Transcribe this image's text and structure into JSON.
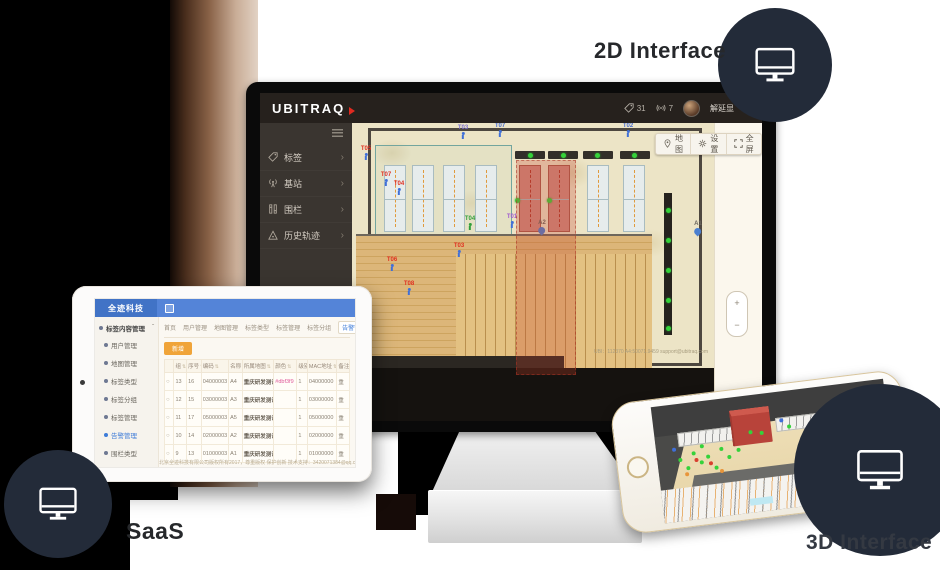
{
  "labels": {
    "label_2d": "2D Interface",
    "label_saas": "SaaS",
    "label_3d": "3D Interface"
  },
  "colors": {
    "badge_navy": "#232b39",
    "header_dark": "#26211d",
    "sidebar_dark": "#3a3530",
    "map_beige": "#ece4c6",
    "fence_red": "#c63f2c",
    "station_green": "#35d23a",
    "tag_blue": "#3f6fd8",
    "tablet_blue": "#5484d8",
    "tablet_logo_blue": "#4173c6",
    "accent_orange": "#f0a439",
    "active_blue": "#3d7bd8"
  },
  "monitor_app": {
    "logo": "UBITRAQ",
    "header": {
      "tag_count": "31",
      "signal_count": "7",
      "username": "解延显",
      "caret": "▼"
    },
    "sidebar_chevron": "›",
    "sidebar": [
      {
        "icon": "tag-icon",
        "label": "标签"
      },
      {
        "icon": "station-icon",
        "label": "基站"
      },
      {
        "icon": "fence-icon",
        "label": "围栏"
      },
      {
        "icon": "history-icon",
        "label": "历史轨迹"
      }
    ],
    "toolbar": [
      {
        "icon": "pin-icon",
        "label": "地图"
      },
      {
        "icon": "gear-icon",
        "label": "设置"
      },
      {
        "icon": "fullscreen-icon",
        "label": "全屏"
      }
    ],
    "zoom_in": "+",
    "zoom_out": "−",
    "watermark": "UBI：112370 A4:50071.9459 support@ubitraq.com",
    "map": {
      "racks": [
        {
          "x": 32,
          "y": 42,
          "red": false
        },
        {
          "x": 60,
          "y": 42,
          "red": false
        },
        {
          "x": 91,
          "y": 42,
          "red": false
        },
        {
          "x": 123,
          "y": 42,
          "red": false
        },
        {
          "x": 167,
          "y": 42,
          "red": true
        },
        {
          "x": 196,
          "y": 42,
          "red": true
        },
        {
          "x": 235,
          "y": 42,
          "red": false
        },
        {
          "x": 271,
          "y": 42,
          "red": false
        }
      ],
      "caps": [
        163,
        196,
        231,
        268
      ],
      "station_dots": [
        [
          178,
          32
        ],
        [
          211,
          32
        ],
        [
          245,
          32
        ],
        [
          282,
          32
        ],
        [
          165,
          77
        ],
        [
          197,
          77
        ],
        [
          316,
          87
        ],
        [
          316,
          117
        ],
        [
          316,
          147
        ],
        [
          316,
          177
        ],
        [
          316,
          205
        ]
      ],
      "tags": [
        {
          "x": 14,
          "y": 23,
          "label": "T05",
          "label_color": "#e03020",
          "icon_color": "#3f6fd8"
        },
        {
          "x": 111,
          "y": 2,
          "label": "T03",
          "label_color": "#7a6fd0",
          "icon_color": "#3f6fd8"
        },
        {
          "x": 148,
          "y": 0,
          "label": "T07",
          "label_color": "#4a6fd0",
          "icon_color": "#3f6fd8"
        },
        {
          "x": 276,
          "y": 0,
          "label": "T02",
          "label_color": "#4a6fd0",
          "icon_color": "#3f6fd8"
        },
        {
          "x": 34,
          "y": 49,
          "label": "T07",
          "label_color": "#e03020",
          "icon_color": "#3f6fd8"
        },
        {
          "x": 47,
          "y": 58,
          "label": "T04",
          "label_color": "#e03020",
          "icon_color": "#3f6fd8"
        },
        {
          "x": 118,
          "y": 93,
          "label": "T04",
          "label_color": "#2f9e3a",
          "icon_color": "#2f9e3a"
        },
        {
          "x": 160,
          "y": 91,
          "label": "T01",
          "label_color": "#a05bd0",
          "icon_color": "#3f6fd8"
        },
        {
          "x": 40,
          "y": 134,
          "label": "T06",
          "label_color": "#e03020",
          "icon_color": "#3f6fd8"
        },
        {
          "x": 57,
          "y": 158,
          "label": "T08",
          "label_color": "#e03020",
          "icon_color": "#3f6fd8"
        },
        {
          "x": 107,
          "y": 120,
          "label": "T03",
          "label_color": "#e03020",
          "icon_color": "#3f6fd8"
        }
      ],
      "pins": [
        {
          "x": 190,
          "y": 97,
          "label": "A2"
        },
        {
          "x": 346,
          "y": 98,
          "label": "A1"
        }
      ]
    }
  },
  "tablet_app": {
    "logo": "全迹科技",
    "sidebar_header": "标签内容管理",
    "sidebar_header_caret": "ˆ",
    "sidebar_items": [
      {
        "label": "用户管理",
        "active": false
      },
      {
        "label": "地图管理",
        "active": false
      },
      {
        "label": "标签类型",
        "active": false
      },
      {
        "label": "标签分组",
        "active": false
      },
      {
        "label": "标签管理",
        "active": false
      },
      {
        "label": "告警管理",
        "active": true
      },
      {
        "label": "围栏类型",
        "active": false
      },
      {
        "label": "围栏管理",
        "active": false
      },
      {
        "label": "围栏日志",
        "active": false
      }
    ],
    "tabs": [
      {
        "label": "首页",
        "active": false
      },
      {
        "label": "用户管理",
        "active": false
      },
      {
        "label": "地图管理",
        "active": false
      },
      {
        "label": "标签类型",
        "active": false
      },
      {
        "label": "标签管理",
        "active": false
      },
      {
        "label": "标签分组",
        "active": false
      },
      {
        "label": "告警管理",
        "active": true,
        "close": "×"
      }
    ],
    "add_button": "新增",
    "table": {
      "radio_icon": "○",
      "sort_icon": "⇅",
      "headers": [
        "",
        "组",
        "序号",
        "编码",
        "名称",
        "所属地图",
        "颜色",
        "级别",
        "MAC地址",
        "备注"
      ],
      "col_widths": [
        9,
        12,
        14,
        26,
        13,
        30,
        22,
        10,
        28,
        12
      ],
      "rows": [
        [
          "13",
          "16",
          "04000003",
          "A4",
          "重庆研发测试",
          "#dbf3f9",
          "1",
          "04000000",
          "重"
        ],
        [
          "12",
          "15",
          "03000003",
          "A3",
          "重庆研发测试",
          "",
          "1",
          "03000000",
          "重"
        ],
        [
          "11",
          "17",
          "05000003",
          "A5",
          "重庆研发测试",
          "",
          "1",
          "05000000",
          "重"
        ],
        [
          "10",
          "14",
          "02000003",
          "A2",
          "重庆研发测试",
          "",
          "1",
          "02000000",
          "重"
        ],
        [
          "9",
          "13",
          "01000003",
          "A1",
          "重庆研发测试",
          "",
          "1",
          "01000000",
          "重"
        ]
      ]
    },
    "footer": "北京全迹科技有限公司版权所有2017，尊重版权 保护创新 技术支持：3420071384@qq.com"
  },
  "phone_app": {
    "dots": [
      {
        "x": 9,
        "y": 46,
        "c": "#35d23a"
      },
      {
        "x": 12,
        "y": 54,
        "c": "#35d23a"
      },
      {
        "x": 15,
        "y": 42,
        "c": "#35d23a"
      },
      {
        "x": 18,
        "y": 50,
        "c": "#35d23a"
      },
      {
        "x": 21,
        "y": 46,
        "c": "#35d23a"
      },
      {
        "x": 24,
        "y": 56,
        "c": "#35d23a"
      },
      {
        "x": 27,
        "y": 41,
        "c": "#35d23a"
      },
      {
        "x": 30,
        "y": 49,
        "c": "#35d23a"
      },
      {
        "x": 19,
        "y": 37,
        "c": "#35d23a"
      },
      {
        "x": 34,
        "y": 44,
        "c": "#35d23a"
      },
      {
        "x": 40,
        "y": 30,
        "c": "#35d23a"
      },
      {
        "x": 45,
        "y": 32,
        "c": "#35d23a"
      },
      {
        "x": 57,
        "y": 29,
        "c": "#35d23a"
      },
      {
        "x": 66,
        "y": 33,
        "c": "#35d23a"
      },
      {
        "x": 16,
        "y": 48,
        "c": "#d8402f"
      },
      {
        "x": 22,
        "y": 52,
        "c": "#d8402f"
      },
      {
        "x": 11,
        "y": 59,
        "c": "#e8953a"
      },
      {
        "x": 26,
        "y": 60,
        "c": "#e8953a"
      },
      {
        "x": 7,
        "y": 37,
        "c": "#3f6fd8"
      },
      {
        "x": 86,
        "y": 26,
        "c": "#3f6fd8"
      },
      {
        "x": 54,
        "y": 23,
        "c": "#3f6fd8"
      }
    ]
  }
}
